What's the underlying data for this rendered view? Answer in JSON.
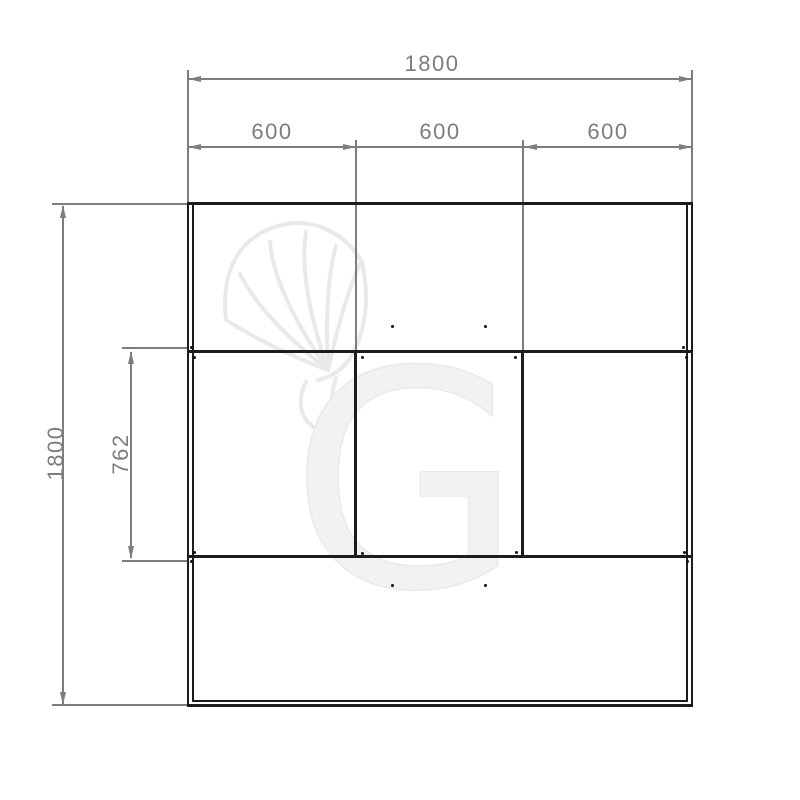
{
  "page": {
    "background": "#ffffff"
  },
  "colors": {
    "background": "#ffffff",
    "outline": "#1c1c1c",
    "dimension": "#7d7d7d",
    "watermark_stroke": "#e9e9e9",
    "watermark_fill": "#f2f2f2"
  },
  "dimensions": {
    "top_total": "1800",
    "top_segments": [
      "600",
      "600",
      "600"
    ],
    "side_total": "1800",
    "side_inner": "762"
  },
  "watermark": {
    "letter": "G"
  }
}
